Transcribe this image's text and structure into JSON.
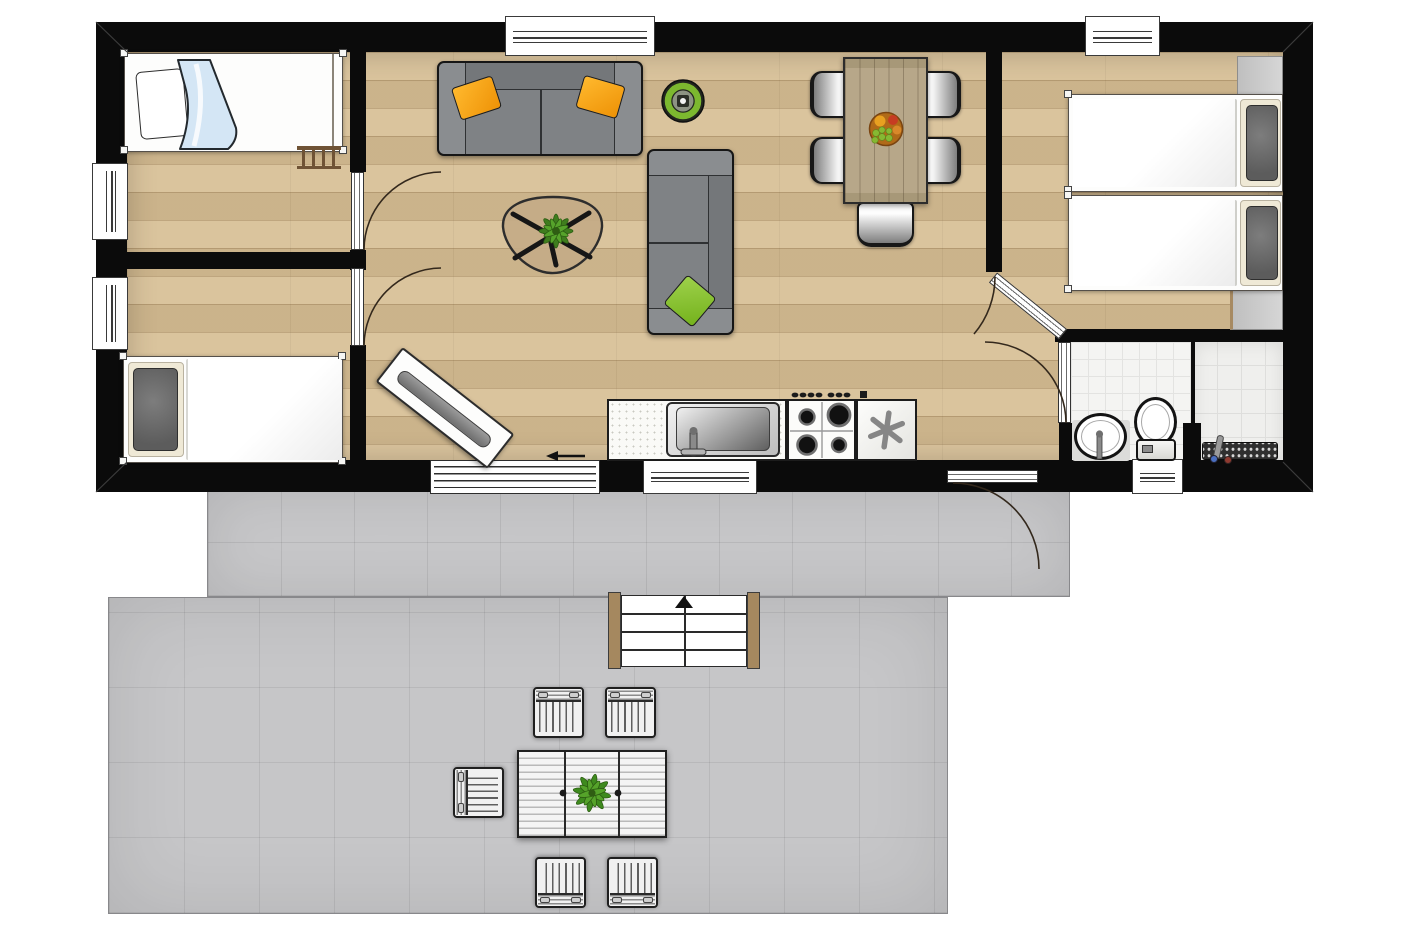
{
  "document": {
    "type": "floor-plan",
    "subject": "single-storey holiday lodge with attached terraces",
    "visible_text": "none",
    "markers": {
      "sliding_door_arrow": "left",
      "stairs_arrow": "up"
    }
  },
  "colors": {
    "wall": "#0b0b0b",
    "wood_floor": "#d6bd92",
    "dining_table_wood": "#b7a789",
    "bathroom_tile": "#f4f4f2",
    "terrace": "#c7c7c9",
    "sofa_gray": "#7f8285",
    "pillow_orange": "#f5a21d",
    "pillow_green": "#86c234",
    "blanket_blue": "#d4e6f5",
    "accent_green_ring": "#7cb82f",
    "fixture_white": "#ffffff"
  },
  "building": {
    "rooms": [
      {
        "name": "bedroom-top-left",
        "floor": "wood",
        "furniture": [
          "single-bed-with-blue-blanket",
          "bed-ladder"
        ]
      },
      {
        "name": "bedroom-bottom-left",
        "floor": "wood",
        "furniture": [
          "single-bed-gray-pillow"
        ]
      },
      {
        "name": "living-dining-kitchen",
        "floor": "wood",
        "furniture": [
          "three-seat-sofa",
          "two-seat-sofa",
          "coffee-table-with-plant",
          "round-green-decor",
          "tv-sideboard-diagonal",
          "dining-table",
          "dining-chair",
          "dining-chair",
          "dining-chair",
          "dining-chair",
          "dining-chair",
          "fruit-bowl",
          "kitchen-counter",
          "kitchen-sink",
          "gas-hob-4-burners",
          "fridge-freezer"
        ]
      },
      {
        "name": "bedroom-right",
        "floor": "wood",
        "furniture": [
          "twin-bed",
          "twin-bed",
          "wardrobe-top",
          "wardrobe-bottom"
        ]
      },
      {
        "name": "bathroom",
        "floor": "tile",
        "furniture": [
          "washbasin",
          "toilet",
          "shower-drain",
          "shower-partition",
          "hand-shower"
        ]
      }
    ],
    "openings": {
      "windows_top": 2,
      "windows_left": 2,
      "windows_bottom": 2,
      "interior_doors": 4,
      "exterior_hinged_doors": 1,
      "sliding_doors": 1
    }
  },
  "outdoor": {
    "upper_terrace": {
      "surface": "gray-tiles"
    },
    "lower_terrace": {
      "surface": "gray-tiles"
    },
    "stairs": {
      "steps": 4,
      "direction_arrow": "up"
    },
    "furniture": [
      "patio-table-with-plant",
      "patio-chair",
      "patio-chair",
      "patio-chair",
      "patio-chair",
      "patio-chair"
    ]
  }
}
